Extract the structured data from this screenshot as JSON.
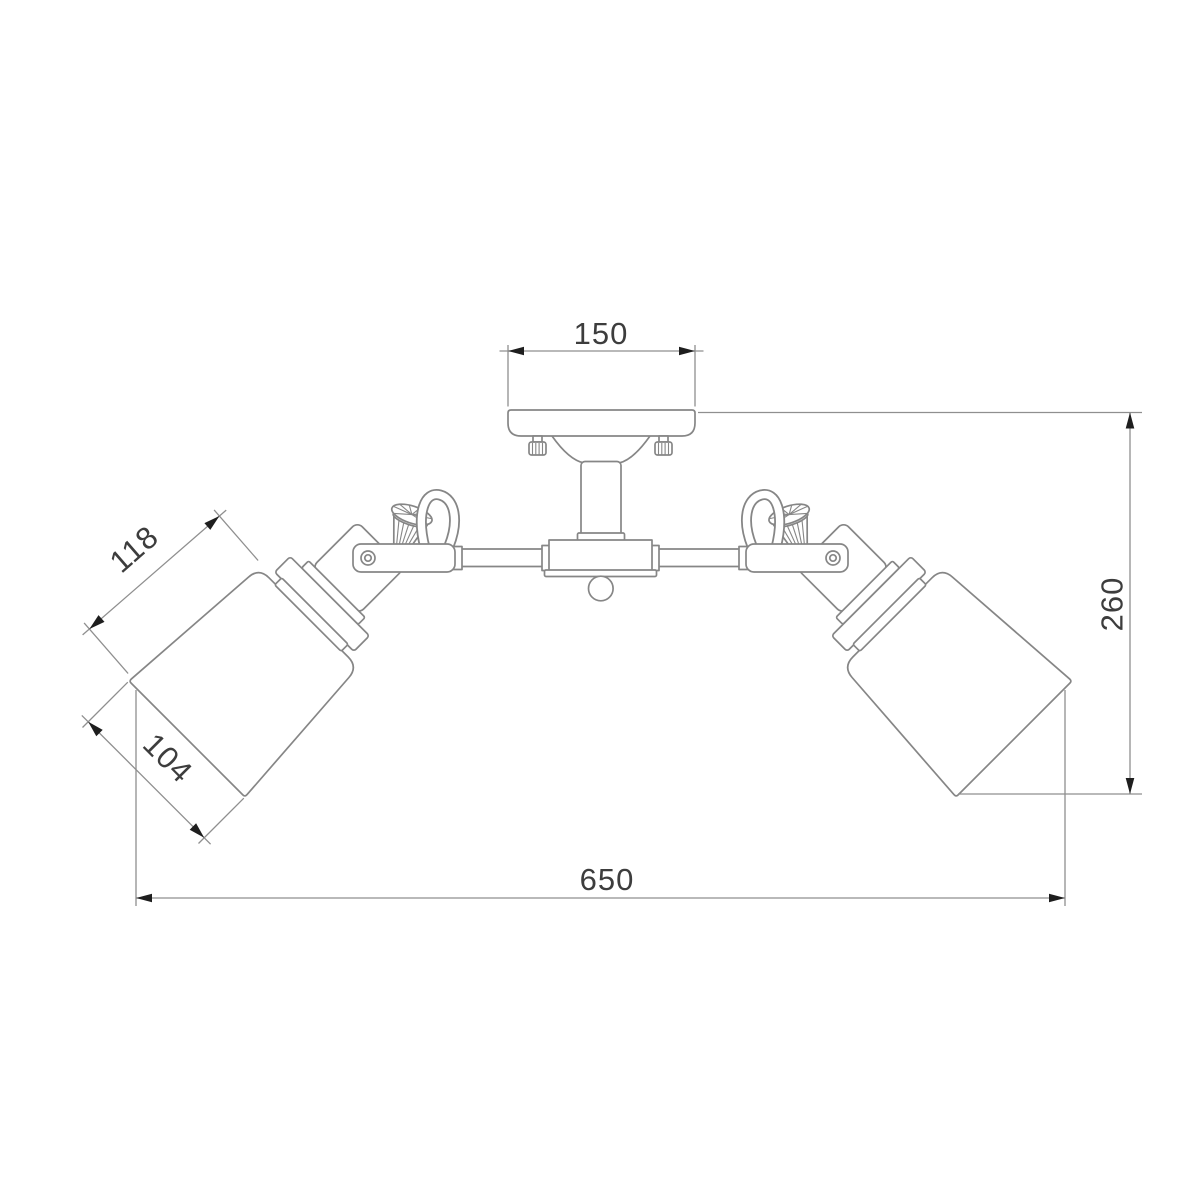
{
  "diagram": {
    "title": "Two-arm ceiling light fixture — dimensioned front elevation",
    "dimensions": {
      "canopy_width": "150",
      "shade_length": "118",
      "shade_diameter": "104",
      "overall_height": "260",
      "overall_width": "650"
    },
    "colors": {
      "background": "#ffffff",
      "outline": "#868686",
      "dimension_line": "#8f8f8f",
      "arrow": "#1e1e1e",
      "text": "#3d3d3d"
    }
  }
}
